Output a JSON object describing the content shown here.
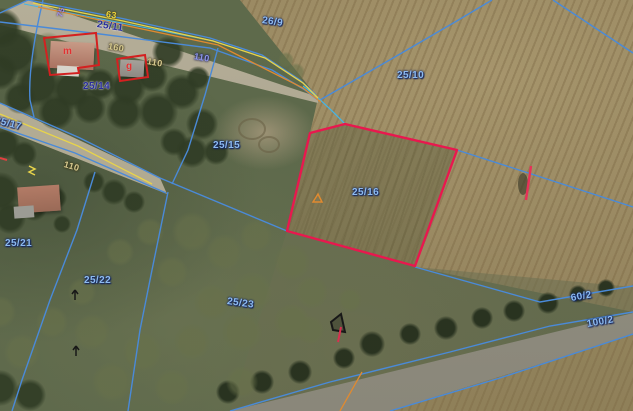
{
  "map": {
    "type": "cadastral-orthophoto-view",
    "selected_parcel": {
      "id": "25/16",
      "outline_color": "#e8184e"
    },
    "labels": {
      "parcel_25_11": "25/11",
      "parcel_25_14": "25/14",
      "parcel_26_9": "26/9",
      "parcel_25_10": "25/10",
      "parcel_25_17": "25/17",
      "parcel_25_15": "25/15",
      "parcel_25_16": "25/16",
      "parcel_25_21": "25/21",
      "parcel_25_22": "25/22",
      "parcel_25_23": "25/23",
      "parcel_60_2": "60/2",
      "parcel_100_2": "100/2",
      "road_110_a": "110",
      "road_110_b": "110",
      "road_110_c": "110",
      "point_160": "160",
      "point_63": "63",
      "point_75": "75",
      "building_m": "m",
      "building_g": "g"
    },
    "colors": {
      "boundary_blue": "#4a8ad8",
      "boundary_cyan": "#45b4e4",
      "selected_red": "#e8184e",
      "building_outline_red": "#d42020",
      "utility_yellow": "#e8d44a",
      "utility_orange": "#e08a30",
      "label_light_blue": "#8cbaf0",
      "label_navy": "#2a2e9a",
      "label_khaki": "#d8cb90"
    }
  }
}
